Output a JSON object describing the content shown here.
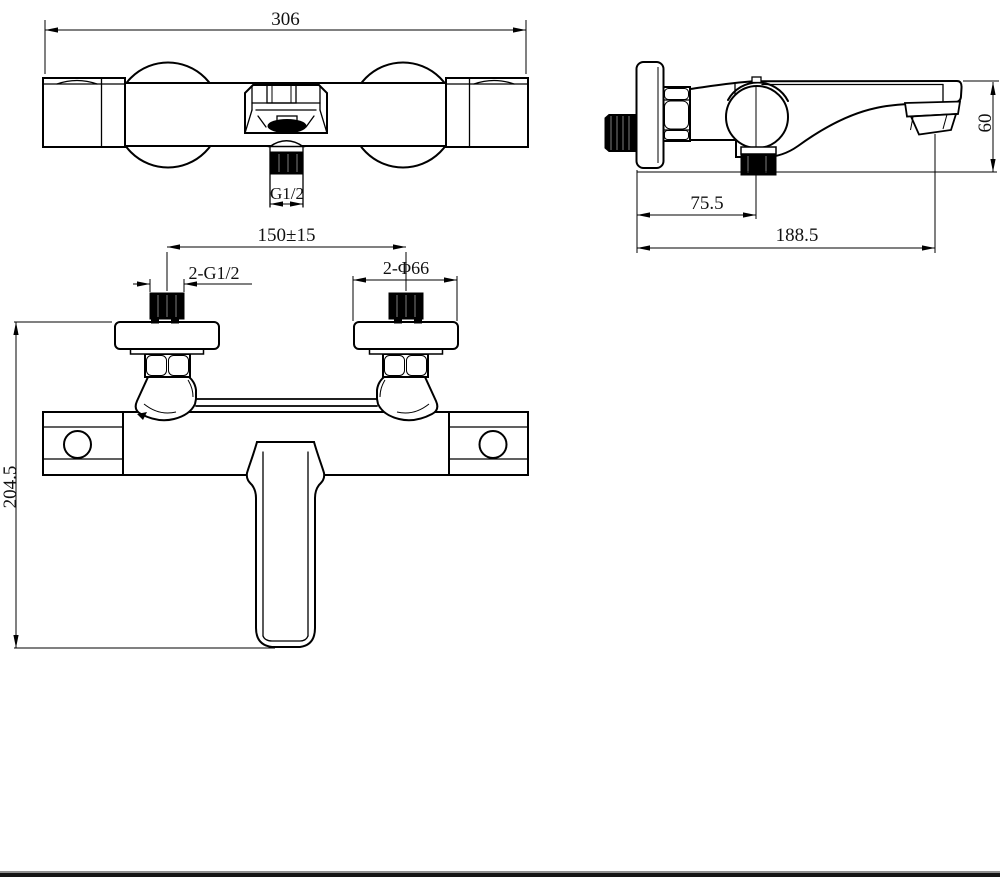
{
  "title": "Wall-mounted bath shower mixer faucet - dimensioned technical drawing",
  "colors": {
    "line": "#000000",
    "background": "#ffffff",
    "footer_bar": "#151515",
    "footer_bar_top": "#909090"
  },
  "views": {
    "front_upper": {
      "label": "valve body front view",
      "dims": {
        "overall_width": "306",
        "outlet_thread": "G1/2"
      }
    },
    "side": {
      "label": "side view",
      "dims": {
        "wall_to_valve_center": "75.5",
        "wall_to_spout_outlet": "188.5",
        "spout_outlet_drop": "60"
      }
    },
    "front_lower": {
      "label": "faucet front view",
      "dims": {
        "inlet_spacing": "150±15",
        "inlet_thread": "2-G1/2",
        "flange_diameter": "2-Φ66",
        "overall_height": "204.5"
      }
    }
  }
}
